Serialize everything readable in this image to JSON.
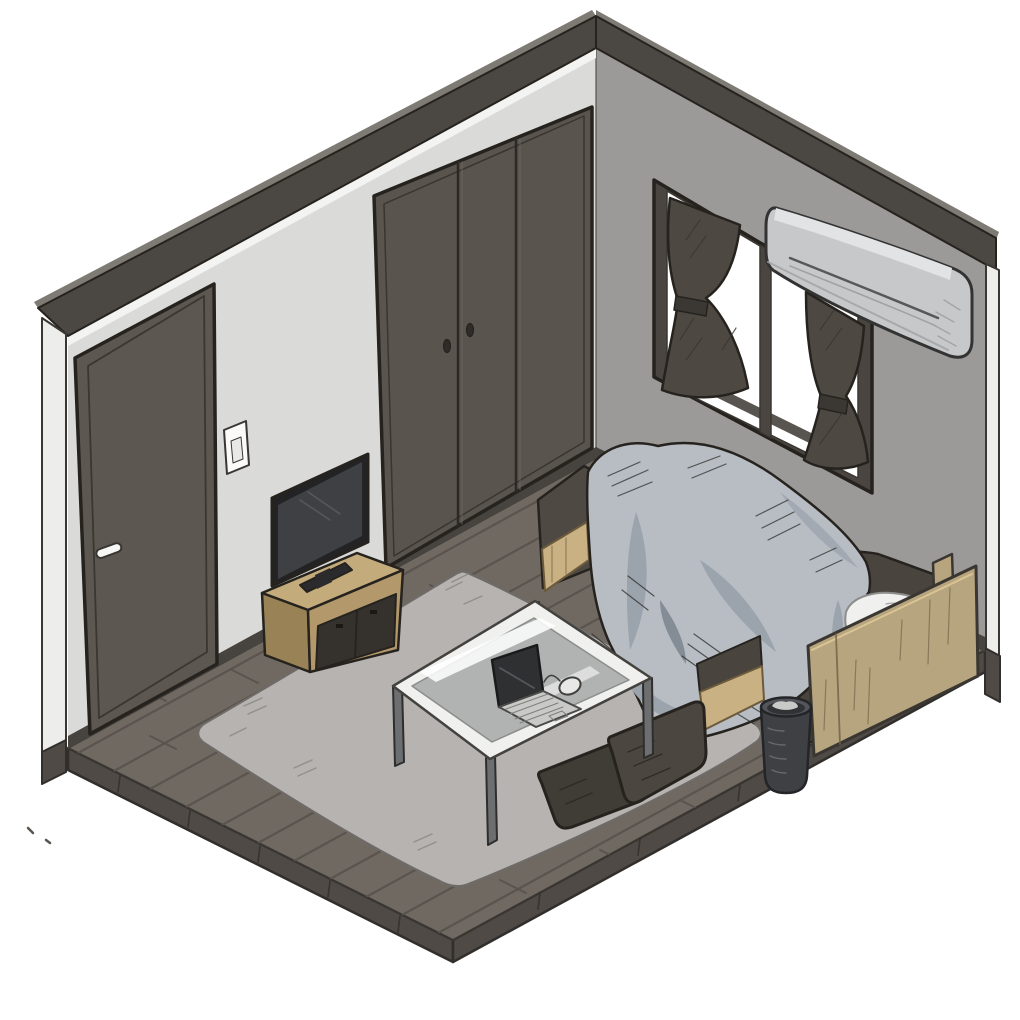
{
  "title": "isometric-bedroom-illustration",
  "scene": {
    "type": "hand-drawn isometric cutaway illustration",
    "room": "small bedroom with two visible walls, wood plank floor and white background",
    "objects": [
      {
        "name": "left-wall",
        "features": [
          "entry-door",
          "light-switch"
        ]
      },
      {
        "name": "closet",
        "features": [
          "three-sliding-panels",
          "two-oval-handles"
        ]
      },
      {
        "name": "right-wall",
        "features": [
          "window-two-panes",
          "tied-curtains",
          "air-conditioner"
        ]
      },
      {
        "name": "floor",
        "features": [
          "dark-wood-planks",
          "visible-slab-edge"
        ]
      },
      {
        "name": "rug",
        "features": [
          "light-gray",
          "rounded-diamond"
        ]
      },
      {
        "name": "tv-stand",
        "features": [
          "wooden",
          "dark-inset-doors"
        ]
      },
      {
        "name": "tv",
        "features": [
          "flat-panel-on-stand"
        ]
      },
      {
        "name": "bed",
        "features": [
          "gray-blue-duvet",
          "dark-mattress",
          "wooden-base",
          "wooden-headboard",
          "white-pillow"
        ]
      },
      {
        "name": "trash-can",
        "features": [
          "dark-cylinder"
        ]
      },
      {
        "name": "coffee-table",
        "features": [
          "glass-top",
          "white-frame",
          "metal-legs"
        ]
      },
      {
        "name": "laptop",
        "features": [
          "open",
          "on-table"
        ]
      },
      {
        "name": "mouse",
        "features": [
          "on-table"
        ]
      },
      {
        "name": "floor-chair",
        "features": [
          "dark-legless-chair"
        ]
      },
      {
        "name": "stray-pen-marks",
        "features": [
          "bottom-left"
        ]
      }
    ]
  },
  "colors": {
    "background": "#ffffff",
    "outline": "#26231f",
    "outline-soft": "#3a3631",
    "wall-left": "#dadad8",
    "wall-left-highlight": "#f3f3f1",
    "wall-right": "#9b9a99",
    "wall-edge-strip": "#ededeb",
    "trim": "#4b4742",
    "trim-top": "#7e7a74",
    "baseboard": "#47433f",
    "corner-line": "#55524e",
    "floor": "#6f6962",
    "floor-plank": "#59534d",
    "floor-side": "#4f4a45",
    "floor-side-edge": "#312e2b",
    "door": "#5d5751",
    "door-panel-line": "#3a3631",
    "door-handle": "#f7f7f5",
    "switch-plate": "#fafaf8",
    "switch-inner": "#e8e8e6",
    "closet": "#5a544f",
    "closet-seam": "#2b2825",
    "closet-handle": "#2e2b28",
    "window-frame": "#4a4540",
    "window-pane": "#ffffff",
    "curtain": "#4e4842",
    "curtain-dark": "#3b3733",
    "ac-body": "#c7c8c9",
    "ac-top": "#e2e3e4",
    "ac-shadow": "#9fa1a3",
    "ac-vent": "#58585a",
    "rug": "#b6b3b0",
    "rug-line": "#8f8c89",
    "rug-edge": "#6e6b68",
    "tv-stand-top": "#c4ab7c",
    "tv-stand-front": "#b2986b",
    "tv-stand-side": "#9a8257",
    "tv-stand-inset": "#35322e",
    "tv-frame": "#232325",
    "tv-screen": "#3f4043",
    "tv-highlight": "#5a5b5e",
    "bed-mattress": "#4a443e",
    "bed-mattress-foot": "#4f4943",
    "bed-base-wood": "#c9b183",
    "bed-wood-grain": "#6b5a3c",
    "headboard": "#b7a57f",
    "headboard-grain": "#6f6046",
    "headboard-edge": "#e0c897",
    "duvet": "#b7bdc3",
    "duvet-shade": "#9ba3ac",
    "duvet-shade-dark": "#848c96",
    "duvet-line": "#2e2c29",
    "pillow": "#f0f0ee",
    "pillow-line": "#a8a8a6",
    "trash-body": "#3e4043",
    "trash-rim": "#53555a",
    "trash-inner": "#303236",
    "trash-content": "#c9c9c7",
    "trash-highlight": "#6b6d70",
    "table-frame": "#f0f0ee",
    "table-frame-line": "#44423f",
    "table-glass": "#a7a9a8",
    "table-glass-streak": "#ffffff",
    "table-leg": "#6c6e70",
    "laptop-screen": "#2f3032",
    "laptop-deck": "#c9cac8",
    "laptop-key": "#7f7f7d",
    "mouse": "#e8e8e6",
    "chair-back": "#4b463f",
    "chair-seat": "#403c36",
    "chair-line": "#2a2723",
    "mark": "#5a544e"
  }
}
